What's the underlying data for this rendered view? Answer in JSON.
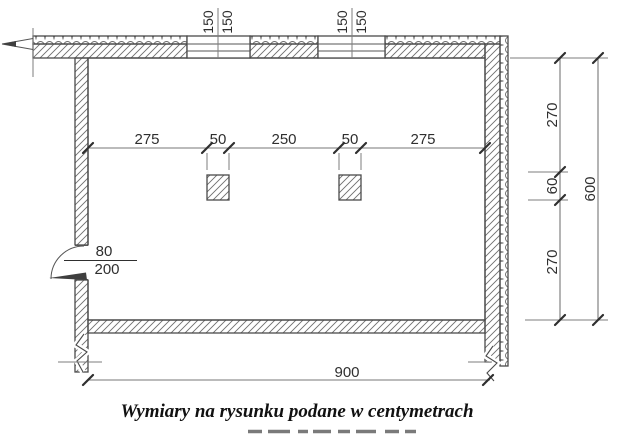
{
  "caption": "Wymiary na rysunku podane w centymetrach",
  "top_windows": [
    {
      "dims": [
        "150",
        "150"
      ]
    },
    {
      "dims": [
        "150",
        "150"
      ]
    }
  ],
  "interior_dim_line": {
    "segments": [
      "275",
      "50",
      "250",
      "50",
      "275"
    ]
  },
  "right_dim_line": {
    "segments": [
      "270",
      "60",
      "270"
    ],
    "overall": "600"
  },
  "door": {
    "dims": [
      "80",
      "200"
    ]
  },
  "bottom_dim_line": {
    "overall": "900"
  },
  "colors": {
    "wall_line": "#4a4a4a",
    "hatch": "#6e6e6e",
    "dim_line": "#777777",
    "label_text": "#2f2f2f",
    "background": "#ffffff"
  }
}
